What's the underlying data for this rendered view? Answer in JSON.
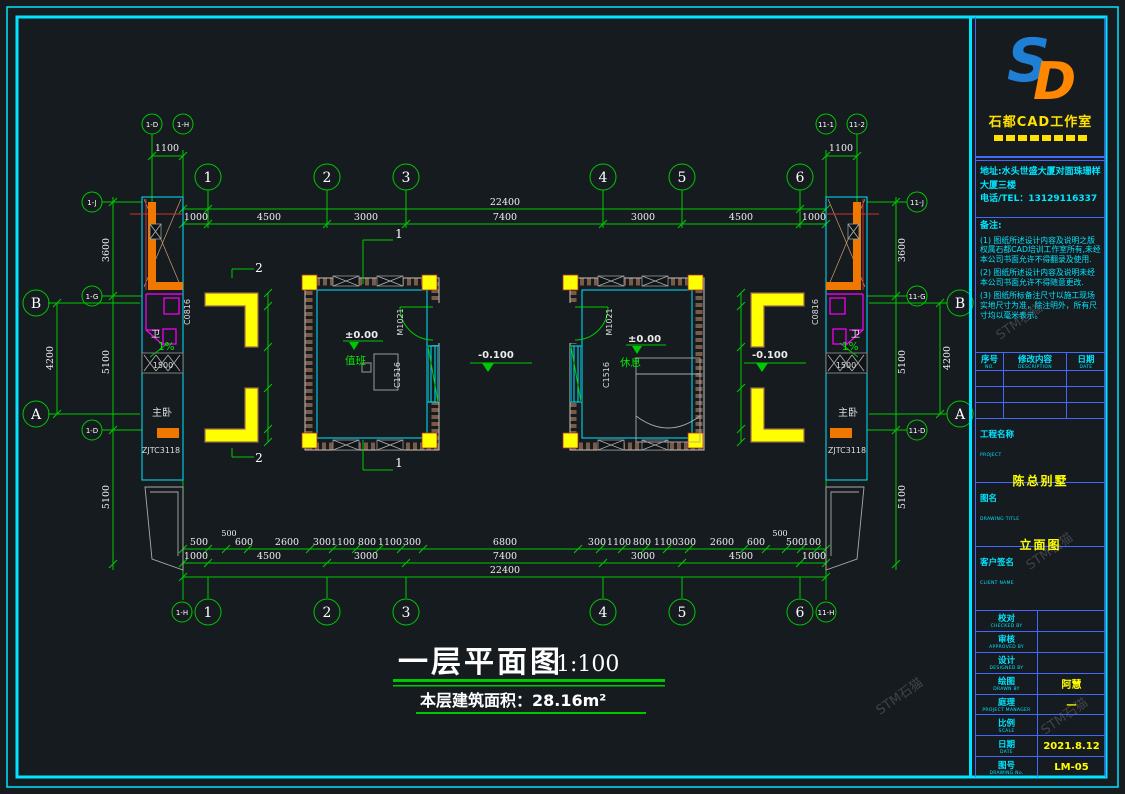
{
  "colors": {
    "background": "#161b20",
    "line_green": "#00c800",
    "frame_cyan": "#00e5ff",
    "value_yellow": "#ffff00",
    "bath_magenta": "#ff00ff",
    "wall_orange": "#f07800",
    "panel_blue": "#4169ff",
    "logo_blue": "#1f7fd4",
    "logo_orange": "#ff8800"
  },
  "plan": {
    "axes": [
      "1",
      "2",
      "3",
      "4",
      "5",
      "6"
    ],
    "side_axes": [
      "B",
      "A"
    ],
    "sub_axes": {
      "tl1": "1-D",
      "tl2": "1-H",
      "tr1": "11-1",
      "tr2": "11-2",
      "l1": "1-J",
      "l2": "1-G",
      "l3": "1-D",
      "r1": "11-J",
      "r2": "11-G",
      "r3": "11-D",
      "bl": "1-H",
      "br": "11-H"
    },
    "dims": {
      "total": "22400",
      "segments": [
        "1000",
        "4500",
        "3000",
        "7400",
        "3000",
        "4500",
        "1000"
      ],
      "offset": "1100",
      "side": [
        "3600",
        "5100",
        "5100"
      ],
      "side_outer": "4200",
      "detail_left": [
        "500",
        "500",
        "600",
        "2600",
        "300",
        "1100",
        "800",
        "1100",
        "300"
      ],
      "detail_center": "6800",
      "detail_right": [
        "300",
        "1100",
        "800",
        "1100",
        "300",
        "2600",
        "600",
        "500",
        "500",
        "100"
      ],
      "wing_window": "1500"
    },
    "labels": {
      "duty_room": "值班",
      "rest_room": "休息",
      "level_zero": "±0.00",
      "level_neg": "-0.100",
      "door": "M1021",
      "window_c1516": "C1516",
      "window_c0816": "C0816",
      "master": "主卧",
      "code": "ZJTC3118",
      "wc": "卫",
      "slope": "1%",
      "section1": "1",
      "section2": "2"
    },
    "title": {
      "text": "一层平面图",
      "scale": "1:100",
      "area": "本层建筑面积：28.16m²"
    }
  },
  "titleblock": {
    "logo_s": "S",
    "logo_d": "D",
    "studio_name": "石都CAD工作室",
    "address_line1": "地址:水头世盛大厦对面珠珊样",
    "address_line2": "大厦三楼",
    "phone": "电话/TEL：13129116337",
    "notes_title": "备注:",
    "notes": [
      "(1) 图纸所述设计内容及说明之版权属石都CAD培训工作室所有,未经本公司书面允许不得翻录及使用.",
      "(2) 图纸所述设计内容及说明未经本公司书面允许不得随意更改.",
      "(3) 图纸所标备注尺寸以施工现场实地尺寸为准，除注明外，所有尺寸均以毫米表示。"
    ],
    "rev": {
      "c1": "序号",
      "c1en": "NO.",
      "c2": "修改内容",
      "c2en": "DESCRIPTION",
      "c3": "日期",
      "c3en": "DATE"
    },
    "project_label": "工程名称",
    "project_en": "PROJECT",
    "project_name": "陈总别墅",
    "dtitle_label": "图名",
    "dtitle_en": "DRAWING TITLE",
    "dtitle": "立面图",
    "client_label": "客户签名",
    "client_en": "CLIENT NAME",
    "rows": [
      {
        "label": "校对",
        "en": "CHECKED BY",
        "value": ""
      },
      {
        "label": "审核",
        "en": "APPROVED BY",
        "value": ""
      },
      {
        "label": "设计",
        "en": "DESIGNED BY",
        "value": ""
      },
      {
        "label": "绘图",
        "en": "DRAWN BY",
        "value": "阿慧"
      },
      {
        "label": "庭理",
        "en": "PROJECT MANAGER",
        "value": "一"
      },
      {
        "label": "比例",
        "en": "SCALE",
        "value": ""
      },
      {
        "label": "日期",
        "en": "DATE",
        "value": "2021.8.12"
      },
      {
        "label": "图号",
        "en": "DRAWING No.",
        "value": "LM-05"
      }
    ]
  },
  "watermark": "STM石猫"
}
